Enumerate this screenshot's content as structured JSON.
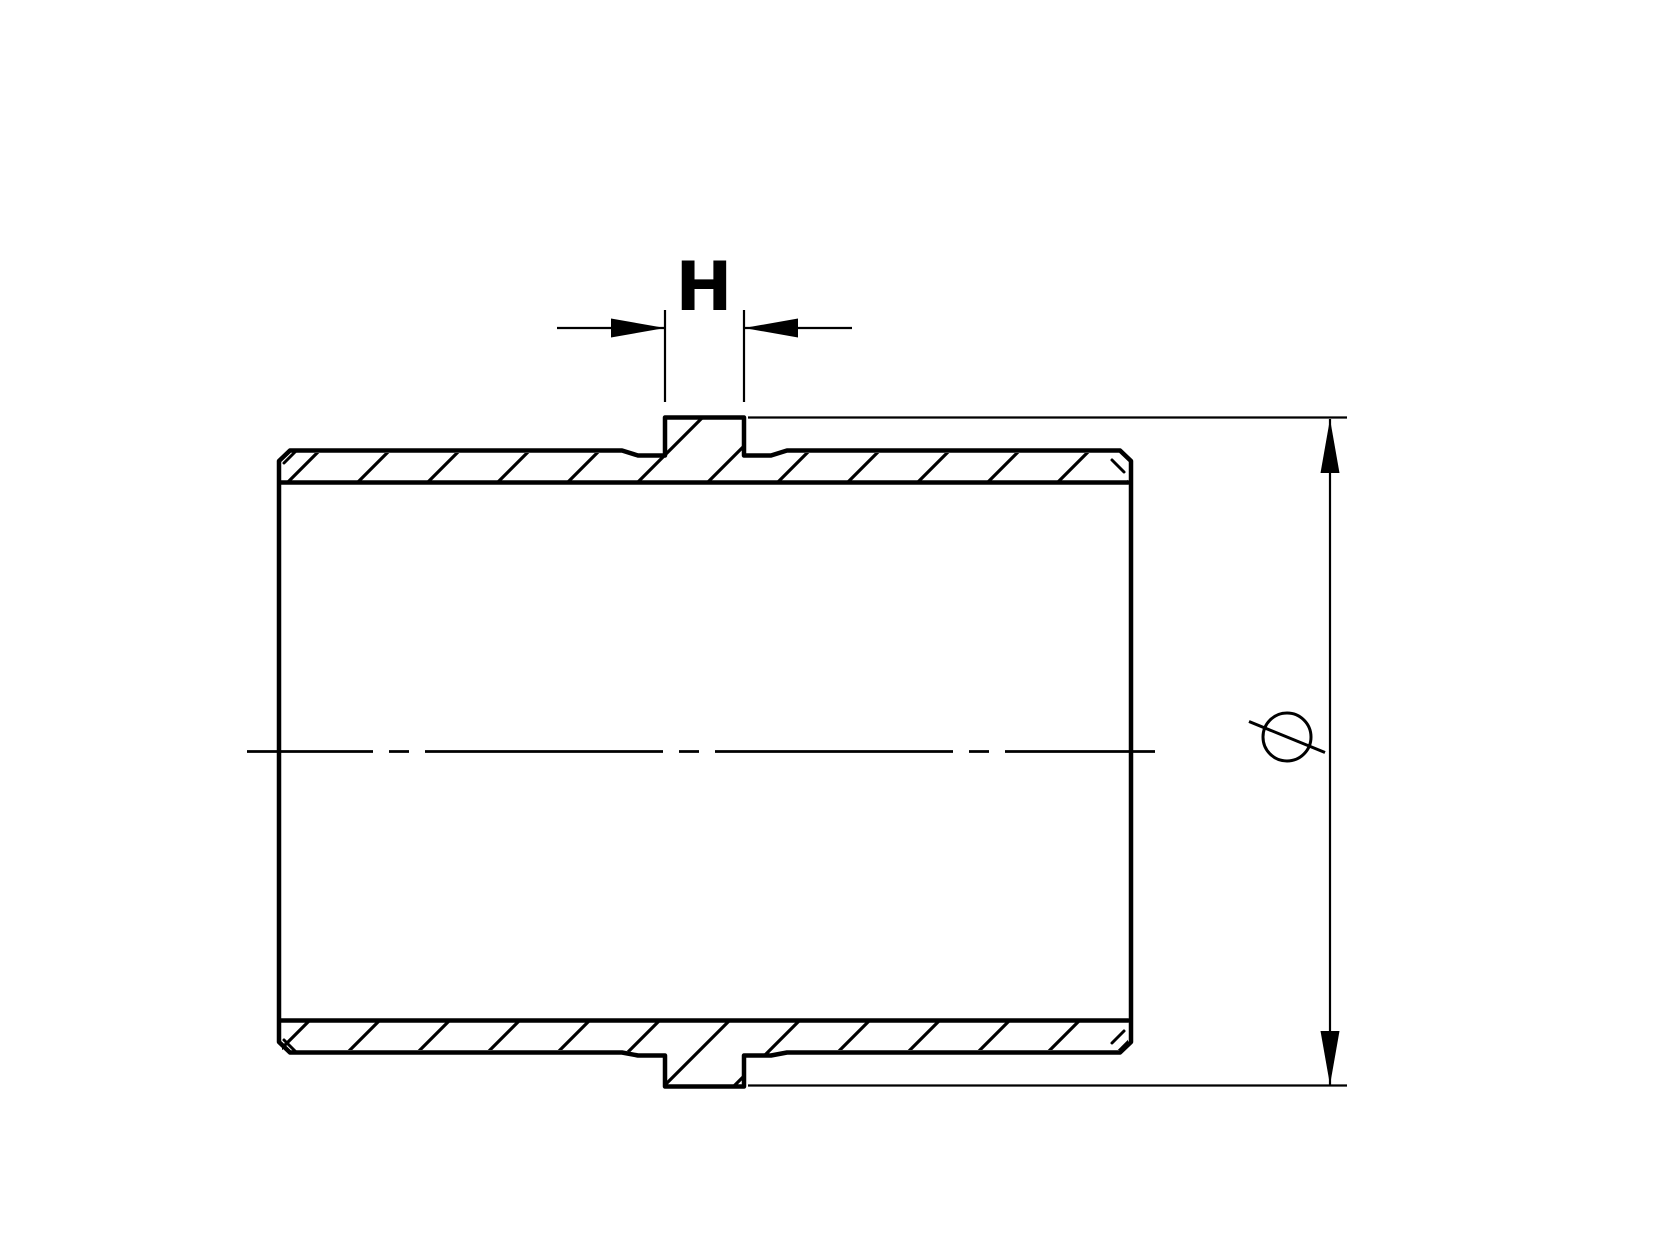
{
  "drawing": {
    "type": "technical-section-drawing",
    "background_color": "#ffffff",
    "line_color": "#000000",
    "part": {
      "description": "cylindrical sleeve shown in half-section with hatched cut walls, raised center boss top and bottom"
    },
    "dimensions": {
      "h": {
        "label": "H"
      },
      "diameter": {
        "symbol": "⌀"
      }
    }
  }
}
